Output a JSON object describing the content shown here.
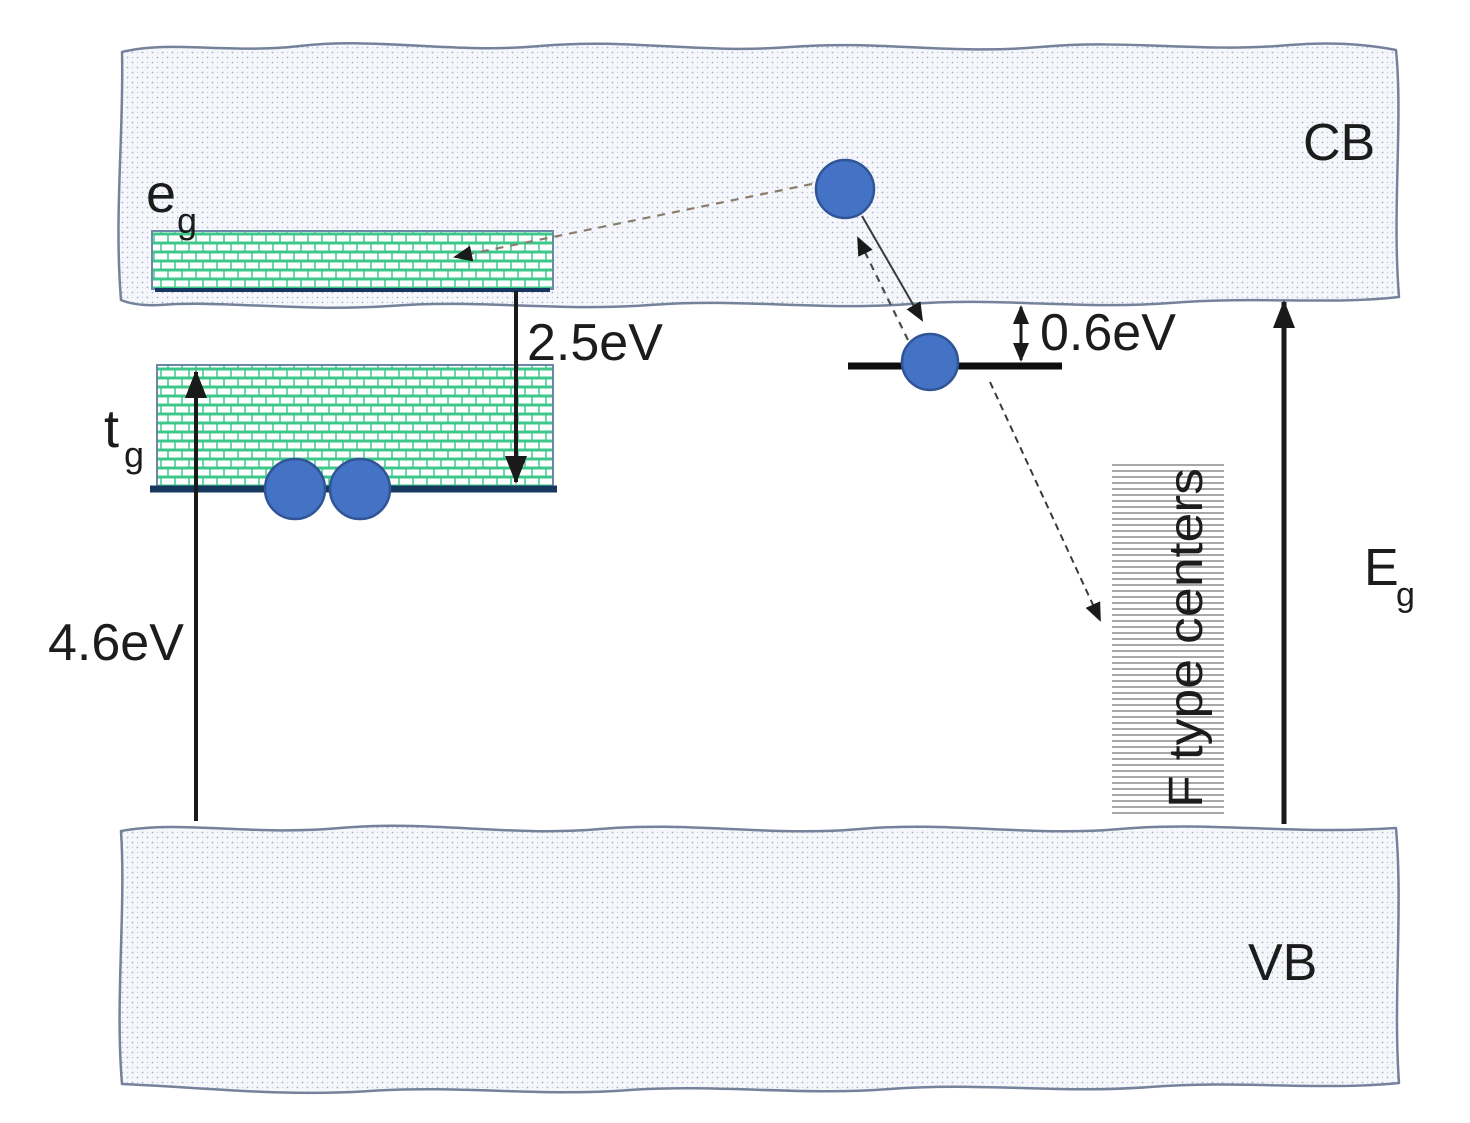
{
  "diagram": {
    "bands": {
      "conduction_label": "CB",
      "valence_label": "VB"
    },
    "levels": {
      "eg_base": "e",
      "eg_sub": "g",
      "tg_base": "t",
      "tg_sub": "g",
      "f_centers_label": "F type centers"
    },
    "energies": {
      "vb_to_tg": "4.6eV",
      "eg_to_tg": "2.5eV",
      "trap_depth": "0.6eV",
      "band_gap_base": "E",
      "band_gap_sub": "g"
    },
    "colors": {
      "electron_fill": "#4472c4",
      "electron_stroke": "#2f5597",
      "brick_green": "#3dc88b",
      "band_fill": "#f5f7fb",
      "band_dot_blue": "#a3aed2",
      "band_border": "#76829b",
      "level_underline_navy": "#17375e",
      "arrow_black": "#1a1a1a",
      "hatch_gray": "#9e9e9e",
      "dashed_arrow_tan": "#8b7d6b"
    }
  }
}
